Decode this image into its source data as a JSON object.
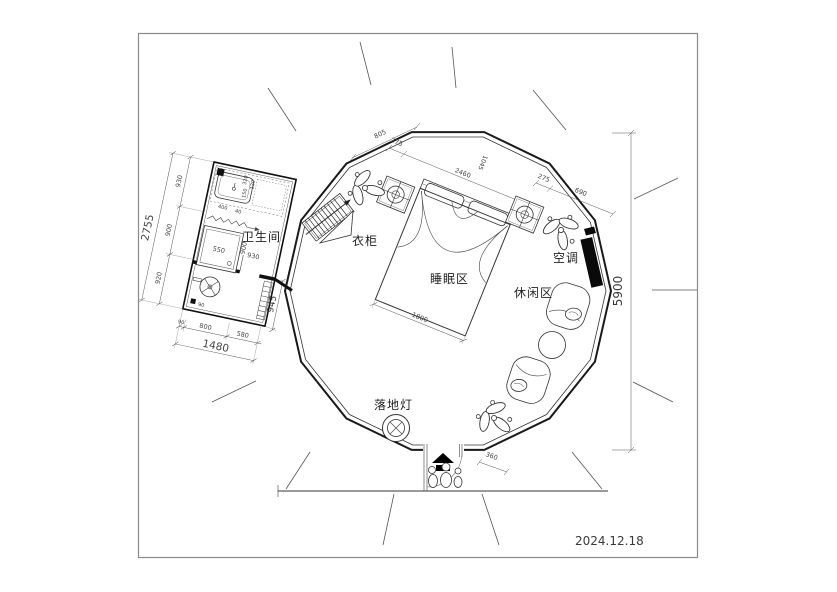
{
  "title_block": {
    "date": "2024.12.18"
  },
  "labels": {
    "bathroom": "卫生间",
    "wardrobe": "衣柜",
    "sleeping_area": "睡眠区",
    "leisure_area": "休闲区",
    "air_conditioner": "空调",
    "floor_lamp": "落地灯"
  },
  "dims": {
    "bath_left_total": "2755",
    "bath_left_seg1": "930",
    "bath_left_seg2": "900",
    "bath_left_seg3": "920",
    "bath_bottom_seg0": "90",
    "bath_bottom_seg1": "800",
    "bath_bottom_seg2": "580",
    "bath_bottom_total": "1480",
    "bath_right": "945",
    "shower": "550",
    "bath_inner_w": "930",
    "bath_inner_h": "900",
    "vanity_1": "320",
    "vanity_2": "120",
    "vanity_3": "150",
    "vanity_4": "400",
    "vanity_5": "40",
    "drain": "90",
    "top_1": "805",
    "top_2": "275",
    "top_3": "2460",
    "top_4": "1045",
    "top_5": "275",
    "top_6": "690",
    "bed_width": "1800",
    "entry": "360",
    "overall": "5900"
  },
  "colors": {
    "line": "#333333",
    "wall": "#1a1a1a",
    "ac_fill": "#0a0a0a",
    "frame": "#8a8a8a"
  }
}
